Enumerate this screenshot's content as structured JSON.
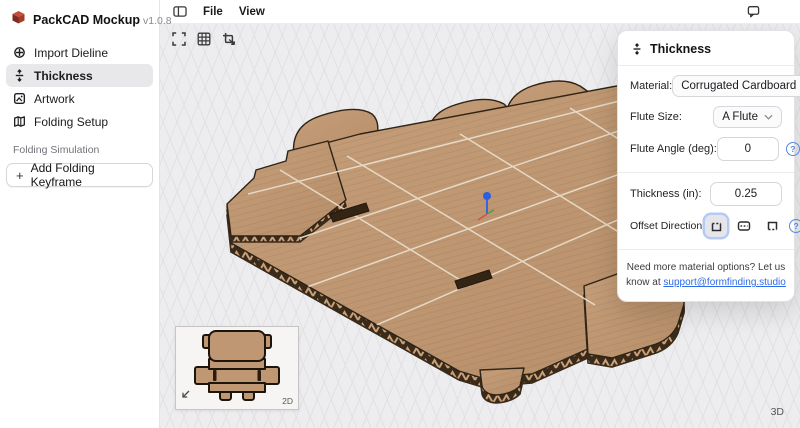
{
  "app": {
    "title": "PackCAD Mockup",
    "version": "v1.0.8",
    "logo_icon": "package-box-icon"
  },
  "sidebar": {
    "items": [
      {
        "label": "Import Dieline",
        "icon": "import-dieline-icon",
        "selected": false
      },
      {
        "label": "Thickness",
        "icon": "thickness-icon",
        "selected": true
      },
      {
        "label": "Artwork",
        "icon": "artwork-icon",
        "selected": false
      },
      {
        "label": "Folding Setup",
        "icon": "folding-setup-icon",
        "selected": false
      }
    ],
    "section_label": "Folding Simulation",
    "keyframe_button_label": "Add Folding Keyframe",
    "keyframe_plus": "+"
  },
  "menubar": {
    "toggle_icon": "sidebar-toggle-icon",
    "items": [
      {
        "label": "File"
      },
      {
        "label": "View"
      }
    ],
    "comment_icon": "comment-bubble-icon",
    "avatar_initial": "A"
  },
  "viewport": {
    "toolbar_icons": [
      "fit-view-icon",
      "grid-icon",
      "crop-transform-icon"
    ],
    "mode_label_3d": "3D",
    "inset": {
      "mode_label": "2D",
      "icon": "collapse-arrow-icon"
    }
  },
  "panel": {
    "title": "Thickness",
    "title_icon": "thickness-icon",
    "material_label": "Material:",
    "material_value": "Corrugated Cardboard",
    "flute_size_label": "Flute Size:",
    "flute_size_value": "A Flute",
    "flute_angle_label": "Flute Angle (deg):",
    "flute_angle_value": "0",
    "thickness_label": "Thickness (in):",
    "thickness_value": "0.25",
    "offset_label": "Offset Direction:",
    "offset_icons": [
      "offset-up-icon",
      "offset-center-icon",
      "offset-down-icon"
    ],
    "note_line1": "Need more material options? Let us",
    "note_line2_prefix": "know at ",
    "note_link": "support@formfinding.studio"
  },
  "colors": {
    "accent_blue": "#2b5fe3",
    "link_blue": "#2f6be8",
    "avatar_green": "#15614a",
    "canvas_bg": "#ededef",
    "grid_line": "#e1e1e4",
    "cardboard": "#bf9773",
    "cardboard_light": "#c59e7a",
    "cardboard_shade": "#b78e69",
    "cardboard_dark_edge": "#3a2a19",
    "flute_tan": "#c9a079",
    "outline_brown": "#2e2315",
    "crease": "#eadfce",
    "gizmo_green": "#44a04e",
    "gizmo_red": "#cf5448",
    "selected_item_bg": "#e8e8ea"
  }
}
